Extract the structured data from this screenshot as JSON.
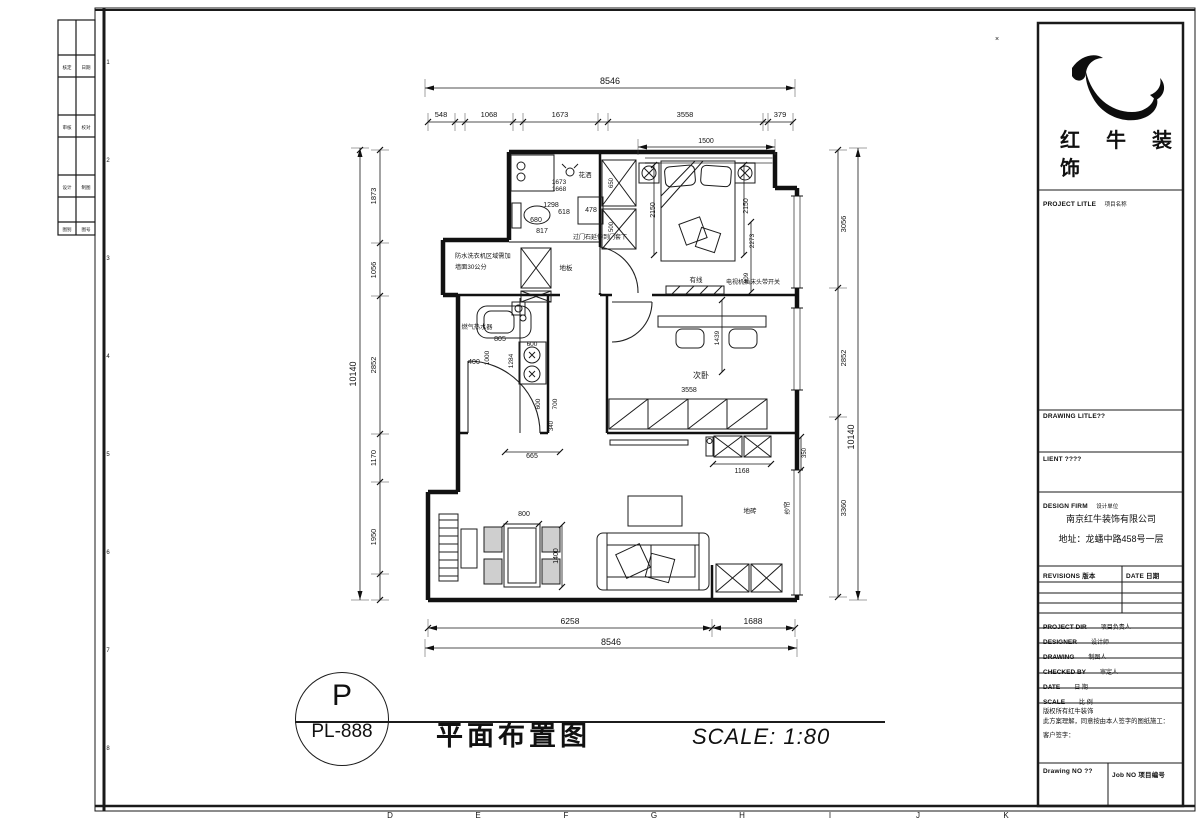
{
  "sheet": {
    "grid_letters": [
      [
        390,
        818,
        "D",
        0,
        8
      ],
      [
        478,
        818,
        "E",
        0,
        8
      ],
      [
        566,
        818,
        "F",
        0,
        8
      ],
      [
        654,
        818,
        "G",
        0,
        8
      ],
      [
        742,
        818,
        "H",
        0,
        8
      ],
      [
        830,
        818,
        "I",
        0,
        8
      ],
      [
        918,
        818,
        "J",
        0,
        8
      ],
      [
        1006,
        818,
        "K",
        0,
        8
      ]
    ],
    "row_numbers": [
      [
        108,
        64,
        "1",
        0,
        6
      ],
      [
        108,
        162,
        "2",
        0,
        6
      ],
      [
        108,
        260,
        "3",
        0,
        6
      ],
      [
        108,
        358,
        "4",
        0,
        6
      ],
      [
        108,
        456,
        "5",
        0,
        6
      ],
      [
        108,
        554,
        "6",
        0,
        6
      ],
      [
        108,
        652,
        "7",
        0,
        6
      ],
      [
        108,
        750,
        "8",
        0,
        6
      ]
    ],
    "margin_labels": [
      [
        67,
        69,
        "核定",
        0,
        4.5
      ],
      [
        86,
        69,
        "日期",
        0,
        4.5
      ],
      [
        67,
        129,
        "审核",
        0,
        4.5
      ],
      [
        86,
        129,
        "校对",
        0,
        4.5
      ],
      [
        67,
        189,
        "设计",
        0,
        4.5
      ],
      [
        86,
        189,
        "制图",
        0,
        4.5
      ],
      [
        67,
        231,
        "图别",
        0,
        4.5
      ],
      [
        86,
        231,
        "图号",
        0,
        4.5
      ]
    ]
  },
  "title_block": {
    "brand_line1": "红牛装",
    "brand_line2": "饰",
    "project_title_en": "PROJECT LITLE",
    "project_title_zh": "项目名称",
    "drawing_title_en": "DRAWING LITLE??",
    "client_en": "LIENT ????",
    "design_firm_en": "DESIGN FIRM",
    "design_firm_zh": "设计单位",
    "company": "南京红牛装饰有限公司",
    "address": "地址：龙蟠中路458号一层",
    "revisions_en": "REVISIONS 版本",
    "date_col_en": "DATE 日期",
    "rows": [
      {
        "en": "PROJECT DIR",
        "zh": "项目负责人"
      },
      {
        "en": "DESIGNER",
        "zh": "设计师"
      },
      {
        "en": "DRAWING",
        "zh": "制图人"
      },
      {
        "en": "CHECKED BY",
        "zh": "审定人"
      },
      {
        "en": "DATE",
        "zh": "日 期"
      },
      {
        "en": "SCALE",
        "zh": "比 例"
      }
    ],
    "copyright_line1": "版权所有红牛装饰",
    "copyright_line2": "此方案理解，同意按由本人签字的图纸施工：",
    "copyright_line3": "客户签字：",
    "drawing_no_en": "Drawing NO ??",
    "job_no_en": "Job NO 项目编号"
  },
  "footer": {
    "circle_top": "P",
    "circle_bottom": "PL-888",
    "drawing_title": "平面布置图",
    "scale_text": "SCALE: 1:80"
  },
  "plan": {
    "annotations": [
      [
        610,
        84,
        "8546",
        0,
        9
      ],
      [
        441,
        117,
        "548",
        0,
        7.5
      ],
      [
        489,
        117,
        "1068",
        0,
        7.5
      ],
      [
        560,
        117,
        "1673",
        0,
        7.5
      ],
      [
        685,
        117,
        "3558",
        0,
        7.5
      ],
      [
        780,
        117,
        "379",
        0,
        7.5
      ],
      [
        706,
        143,
        "1500",
        0,
        7
      ],
      [
        356,
        374,
        "10140",
        1,
        9
      ],
      [
        376,
        196,
        "1873",
        1,
        7.5
      ],
      [
        376,
        270,
        "1056",
        1,
        7.5
      ],
      [
        376,
        365,
        "2852",
        1,
        7.5
      ],
      [
        376,
        458,
        "1170",
        1,
        7.5
      ],
      [
        376,
        537,
        "1950",
        1,
        7.5
      ],
      [
        846,
        224,
        "3056",
        1,
        7.5
      ],
      [
        846,
        358,
        "2852",
        1,
        7.5
      ],
      [
        846,
        508,
        "3360",
        1,
        7.5
      ],
      [
        854,
        437,
        "10140",
        1,
        9
      ],
      [
        806,
        453,
        "350",
        1,
        6
      ],
      [
        570,
        624,
        "6258",
        0,
        8.5
      ],
      [
        753,
        624,
        "1688",
        0,
        8.5
      ],
      [
        611,
        645,
        "8546",
        0,
        9
      ],
      [
        585,
        177,
        "花洒",
        0,
        6.5
      ],
      [
        559,
        184,
        "1673",
        0,
        6.5
      ],
      [
        559,
        191,
        "1668",
        0,
        6.5
      ],
      [
        551,
        207,
        "1298",
        0,
        7
      ],
      [
        564,
        214,
        "618",
        0,
        7
      ],
      [
        591,
        212,
        "478",
        0,
        7
      ],
      [
        536,
        222,
        "680",
        0,
        7
      ],
      [
        542,
        233,
        "817",
        0,
        7
      ],
      [
        600,
        239,
        "过门石延伸到门套下",
        0,
        6
      ],
      [
        613,
        183,
        "650",
        1,
        6
      ],
      [
        613,
        227,
        "500",
        1,
        6
      ],
      [
        655,
        210,
        "2150",
        1,
        7
      ],
      [
        455,
        258,
        "防水洗衣机区域需加",
        0,
        6.2,
        "start"
      ],
      [
        455,
        269,
        "墙面30公分",
        0,
        6.2,
        "start"
      ],
      [
        566,
        270,
        "地板",
        0,
        6.5
      ],
      [
        748,
        206,
        "2150",
        1,
        7
      ],
      [
        754,
        241,
        "2273",
        1,
        6.5
      ],
      [
        748,
        278,
        "909",
        1,
        6.5
      ],
      [
        696,
        282,
        "有线",
        0,
        6.5
      ],
      [
        753,
        284,
        "电视机插床头带开关",
        0,
        6
      ],
      [
        477,
        329,
        "燃气热水器",
        0,
        6.2
      ],
      [
        500,
        341,
        "805",
        0,
        7
      ],
      [
        489,
        358,
        "1000",
        1,
        6.5
      ],
      [
        513,
        361,
        "1284",
        1,
        6.5
      ],
      [
        474,
        364,
        "400",
        0,
        7
      ],
      [
        532,
        346,
        "600",
        0,
        6.5
      ],
      [
        540,
        404,
        "600",
        1,
        6.5
      ],
      [
        557,
        404,
        "700",
        1,
        6.5
      ],
      [
        553,
        426,
        "340",
        1,
        6
      ],
      [
        532,
        458,
        "665",
        0,
        7
      ],
      [
        701,
        378,
        "次卧",
        0,
        8
      ],
      [
        689,
        392,
        "3558",
        0,
        7
      ],
      [
        719,
        338,
        "1439",
        1,
        6.5
      ],
      [
        742,
        473,
        "1168",
        0,
        7
      ],
      [
        524,
        516,
        "800",
        0,
        7
      ],
      [
        558,
        556,
        "1400",
        1,
        7
      ],
      [
        750,
        513,
        "地砖",
        0,
        6.5
      ],
      [
        789,
        508,
        "纱帘",
        1,
        6.5
      ],
      [
        997,
        41,
        "×",
        0,
        7
      ]
    ]
  }
}
